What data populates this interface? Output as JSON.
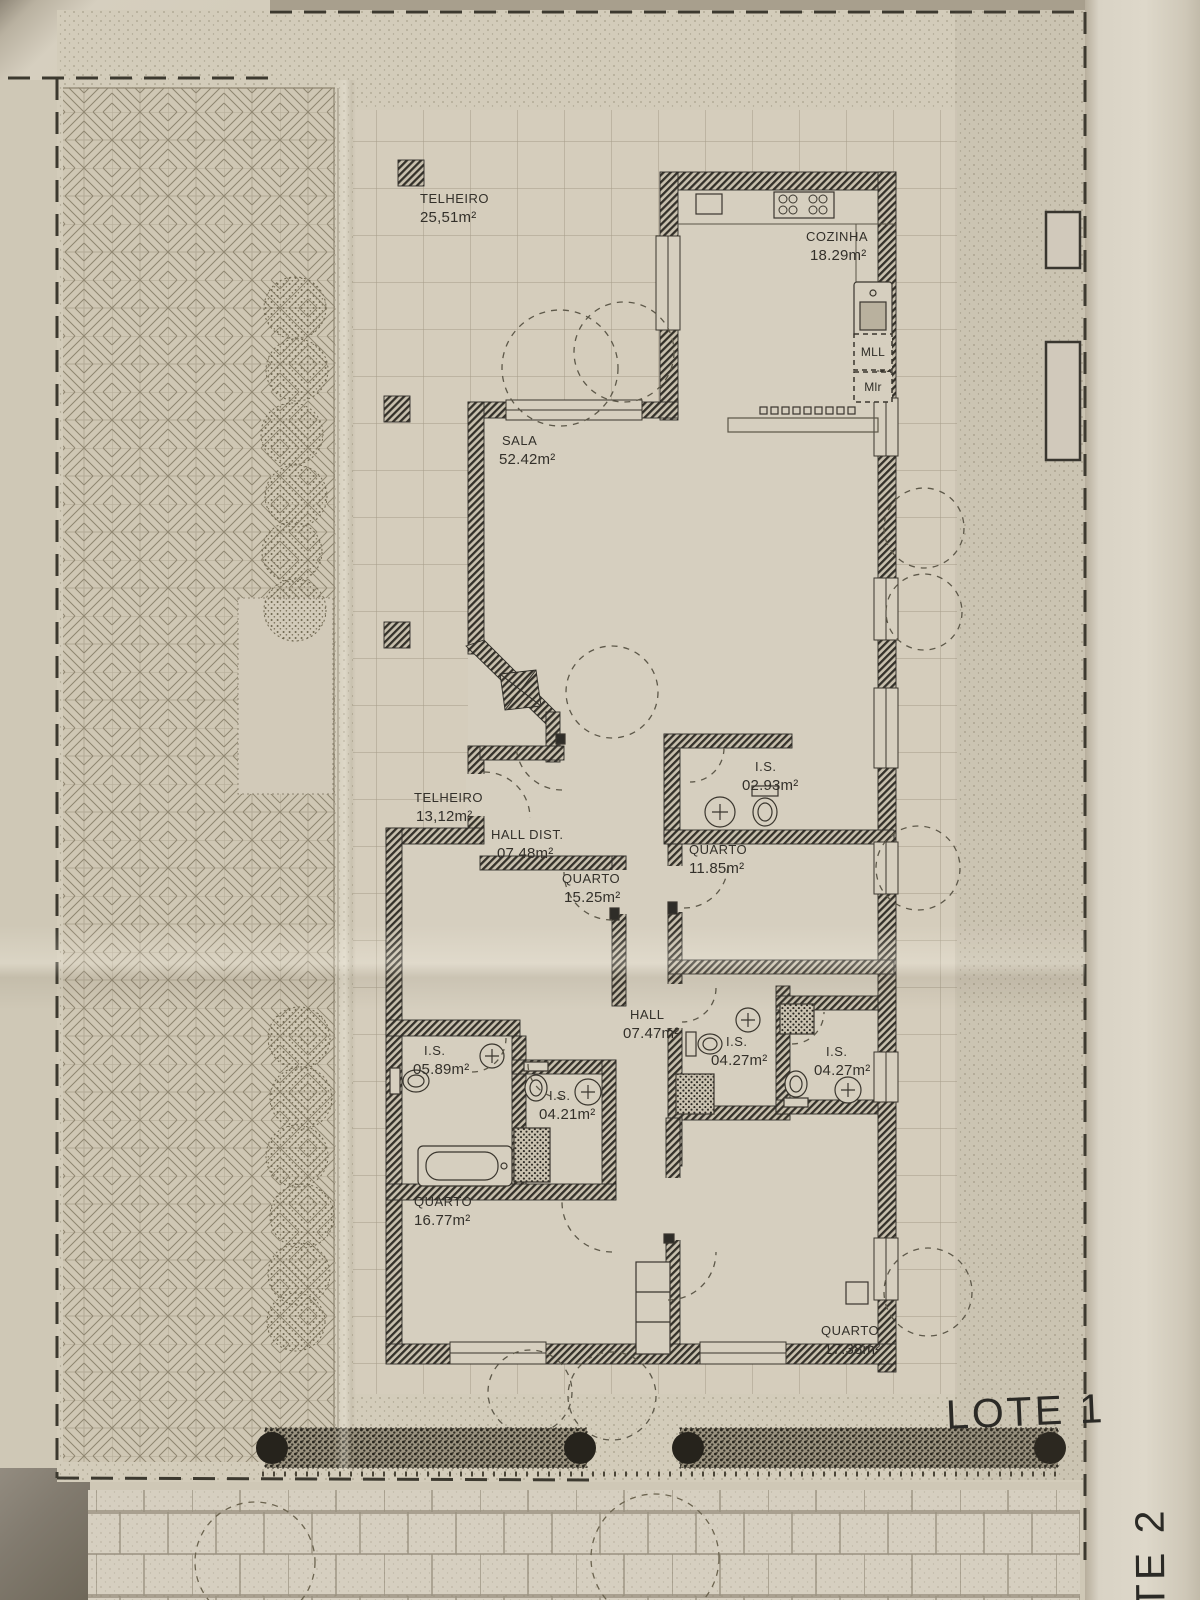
{
  "plan": {
    "rooms": [
      {
        "name": "TELHEIRO",
        "area": "25,51m²"
      },
      {
        "name": "COZINHA",
        "area": "18.29m²"
      },
      {
        "name": "SALA",
        "area": "52.42m²"
      },
      {
        "name": "TELHEIRO",
        "area": "13,12m²"
      },
      {
        "name": "HALL DIST.",
        "area": "07.48m²"
      },
      {
        "name": "I.S.",
        "area": "02.93m²"
      },
      {
        "name": "QUARTO",
        "area": "11.85m²"
      },
      {
        "name": "QUARTO",
        "area": "15.25m²"
      },
      {
        "name": "HALL",
        "area": "07.47m²"
      },
      {
        "name": "I.S.",
        "area": "05.89m²"
      },
      {
        "name": "I.S.",
        "area": "04.21m²"
      },
      {
        "name": "I.S.",
        "area": "04.27m²"
      },
      {
        "name": "I.S.",
        "area": "04.27m²"
      },
      {
        "name": "QUARTO",
        "area": "16.77m²"
      },
      {
        "name": "QUARTO",
        "area": "17.38m²"
      }
    ],
    "appliance_labels": {
      "dishwasher": "MLL",
      "washer": "Mlr"
    },
    "lot_labels": {
      "lot1": "LOTE 1",
      "lot2": "LOTE 2"
    },
    "colors": {
      "paper": "#cfc8b6",
      "paper_light": "#d6cfbf",
      "ink": "#2f2d28",
      "grid_line": "#a59c88",
      "stipple": "#857c66",
      "hedge_dark": "#28251d"
    }
  }
}
